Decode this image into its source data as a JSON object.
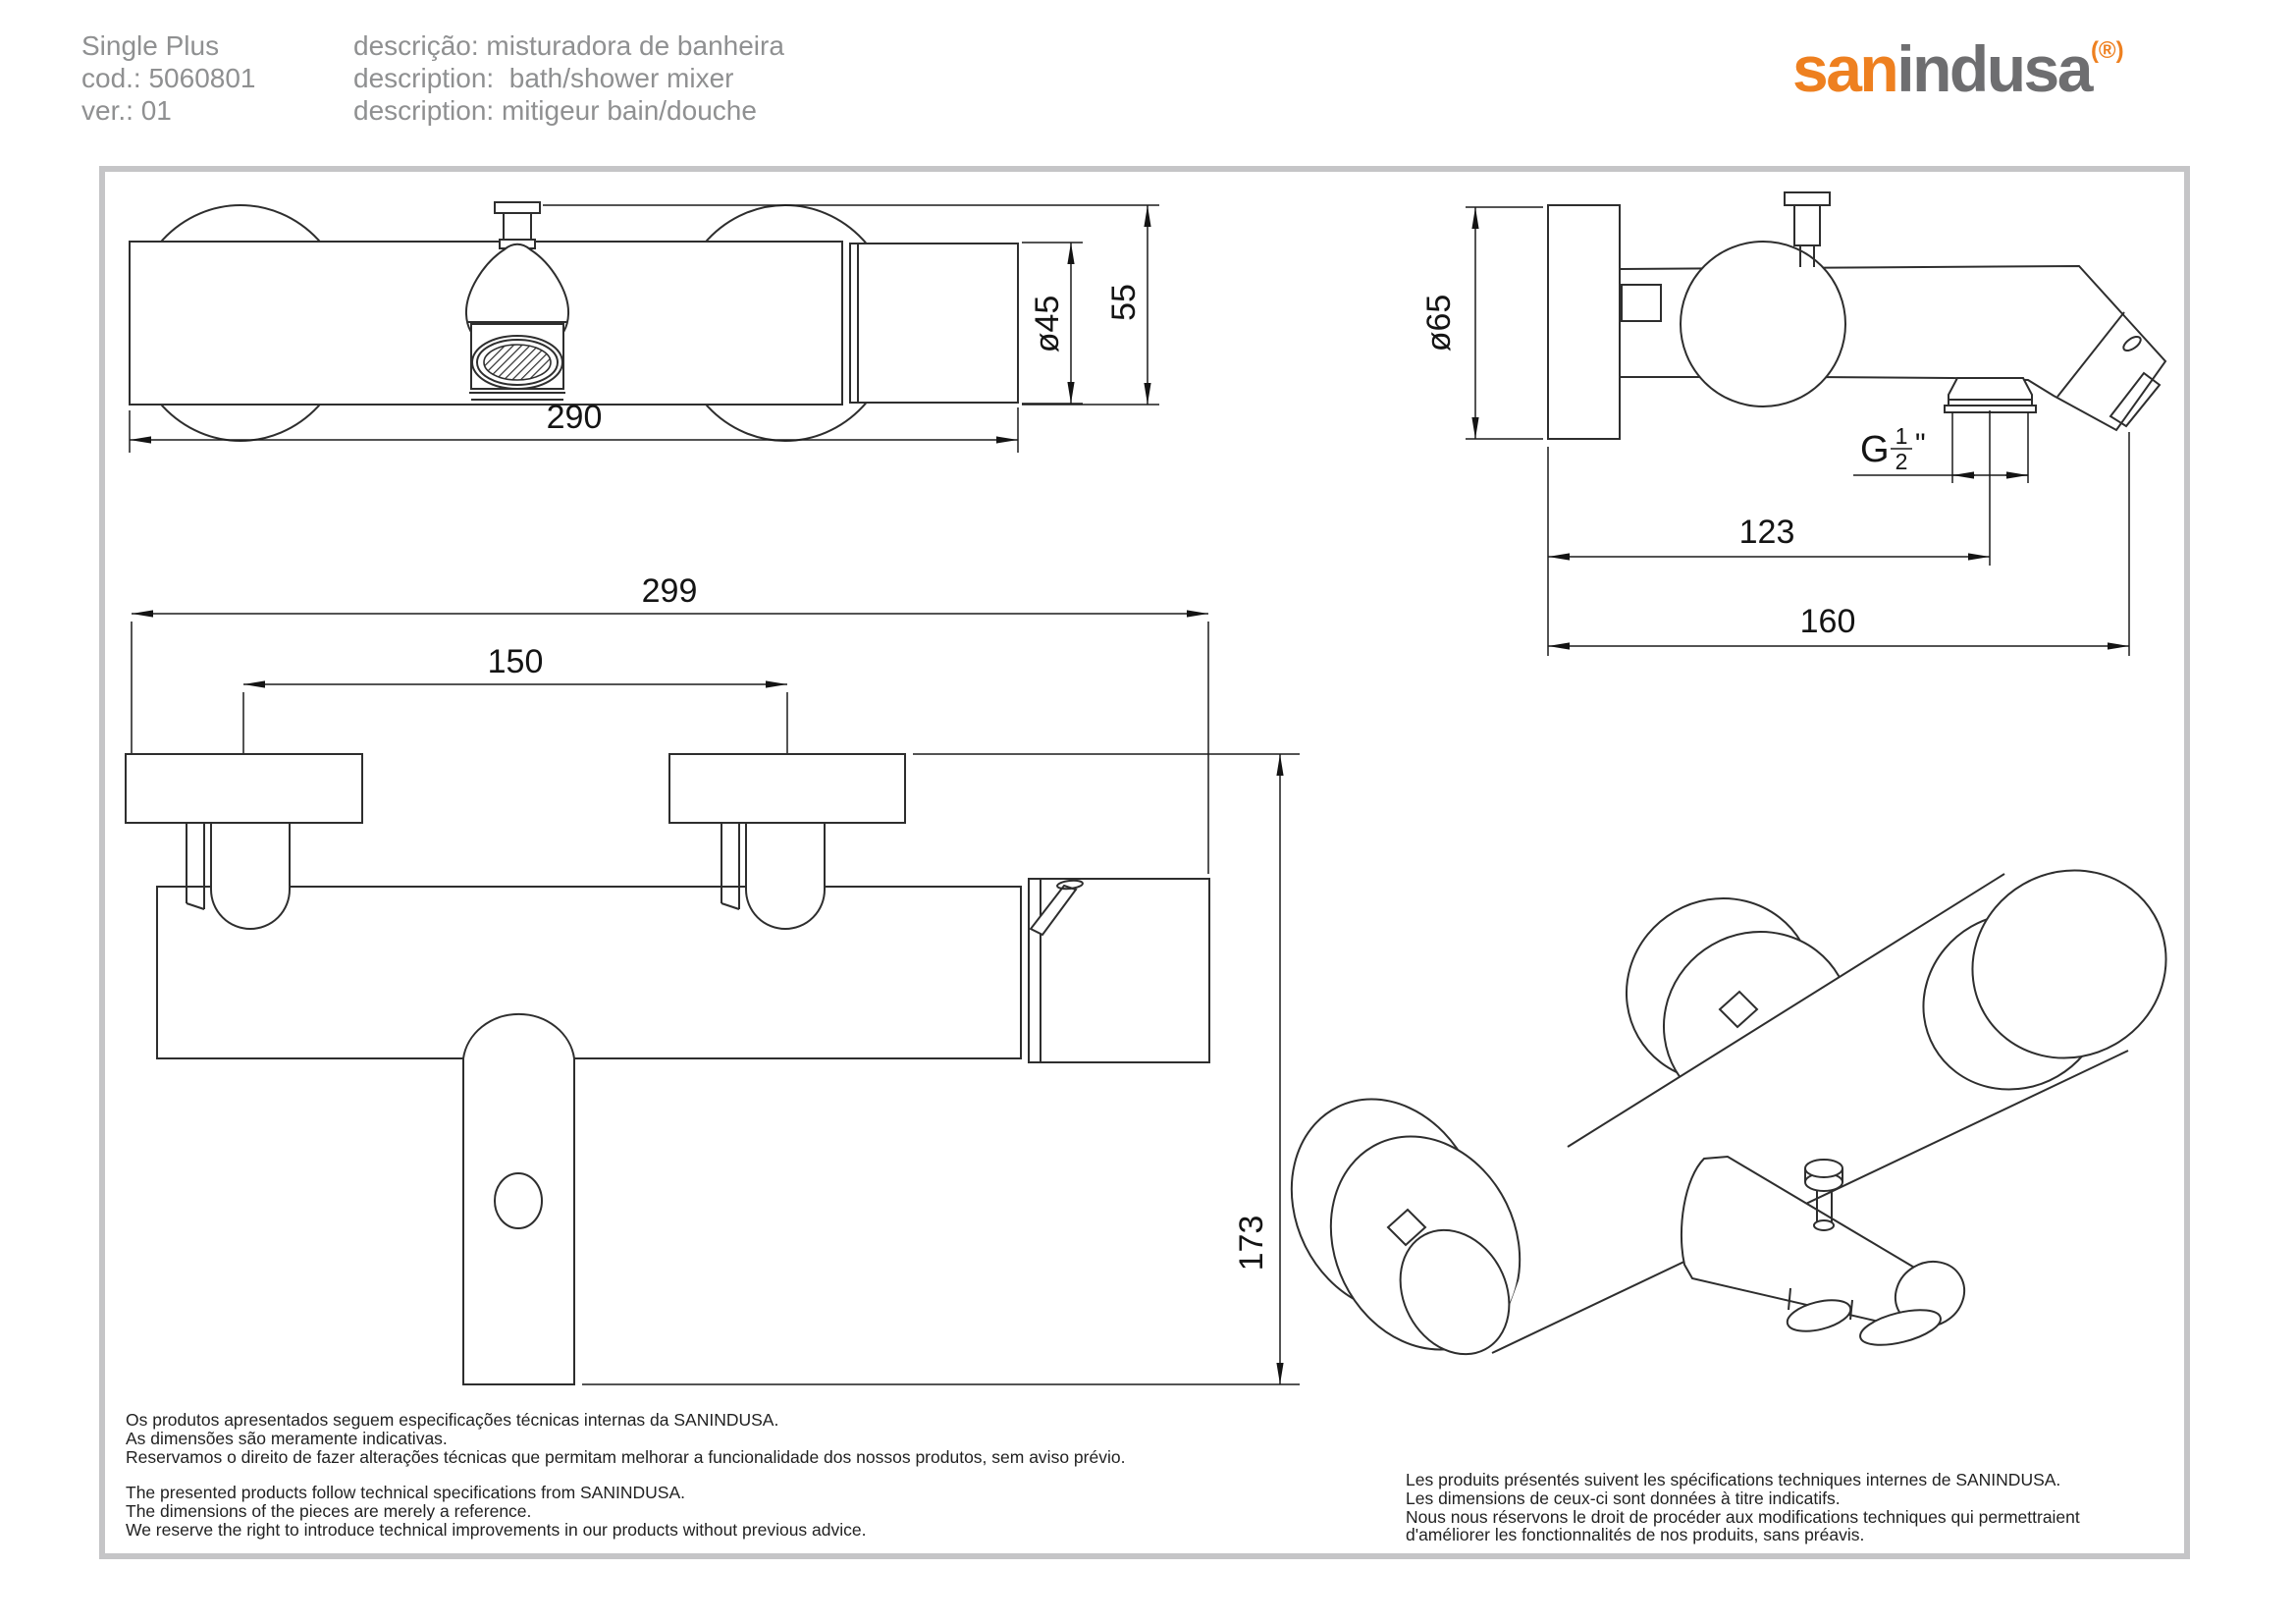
{
  "header": {
    "product_name": "Single Plus",
    "code": "cod.: 5060801",
    "version": "ver.: 01",
    "description_pt": "descrição: misturadora de banheira",
    "description_en": "description:  bath/shower mixer",
    "description_fr": "description: mitigeur bain/douche"
  },
  "logo": {
    "part1": "san",
    "part2": "indusa",
    "registered": "(®)",
    "orange": "#ee8020",
    "gray": "#6e6e70"
  },
  "drawing": {
    "line_color": "#2e2e2e",
    "views": {
      "top_view": {
        "dims": {
          "length": "290",
          "handle_diameter": "ø45",
          "height": "55"
        }
      },
      "side_view": {
        "dims": {
          "flange_diameter": "ø65",
          "thread": {
            "g": "G",
            "num": "1",
            "den": "2",
            "inch": "\""
          },
          "wall_to_shower_outlet": "123",
          "wall_to_spout": "160"
        }
      },
      "front_view": {
        "dims": {
          "total_width": "299",
          "centers_distance": "150",
          "total_height": "173"
        }
      },
      "iso_view": {}
    }
  },
  "footer": {
    "pt": [
      "Os produtos apresentados seguem especificações técnicas internas da SANINDUSA.",
      "As dimensões são meramente indicativas.",
      "Reservamos o direito de fazer alterações técnicas que permitam melhorar a funcionalidade dos nossos produtos, sem aviso prévio."
    ],
    "en": [
      "The presented products follow technical specifications from SANINDUSA.",
      "The dimensions of the pieces are merely a reference.",
      "We reserve the right to introduce technical improvements in our products without previous advice."
    ],
    "fr": [
      "Les produits présentés suivent les spécifications techniques internes de SANINDUSA.",
      "Les dimensions de ceux-ci sont données à titre indicatifs.",
      "Nous nous réservons le droit de procéder aux modifications techniques qui permettraient",
      "d'améliorer les fonctionnalités de nos produits, sans préavis."
    ]
  }
}
